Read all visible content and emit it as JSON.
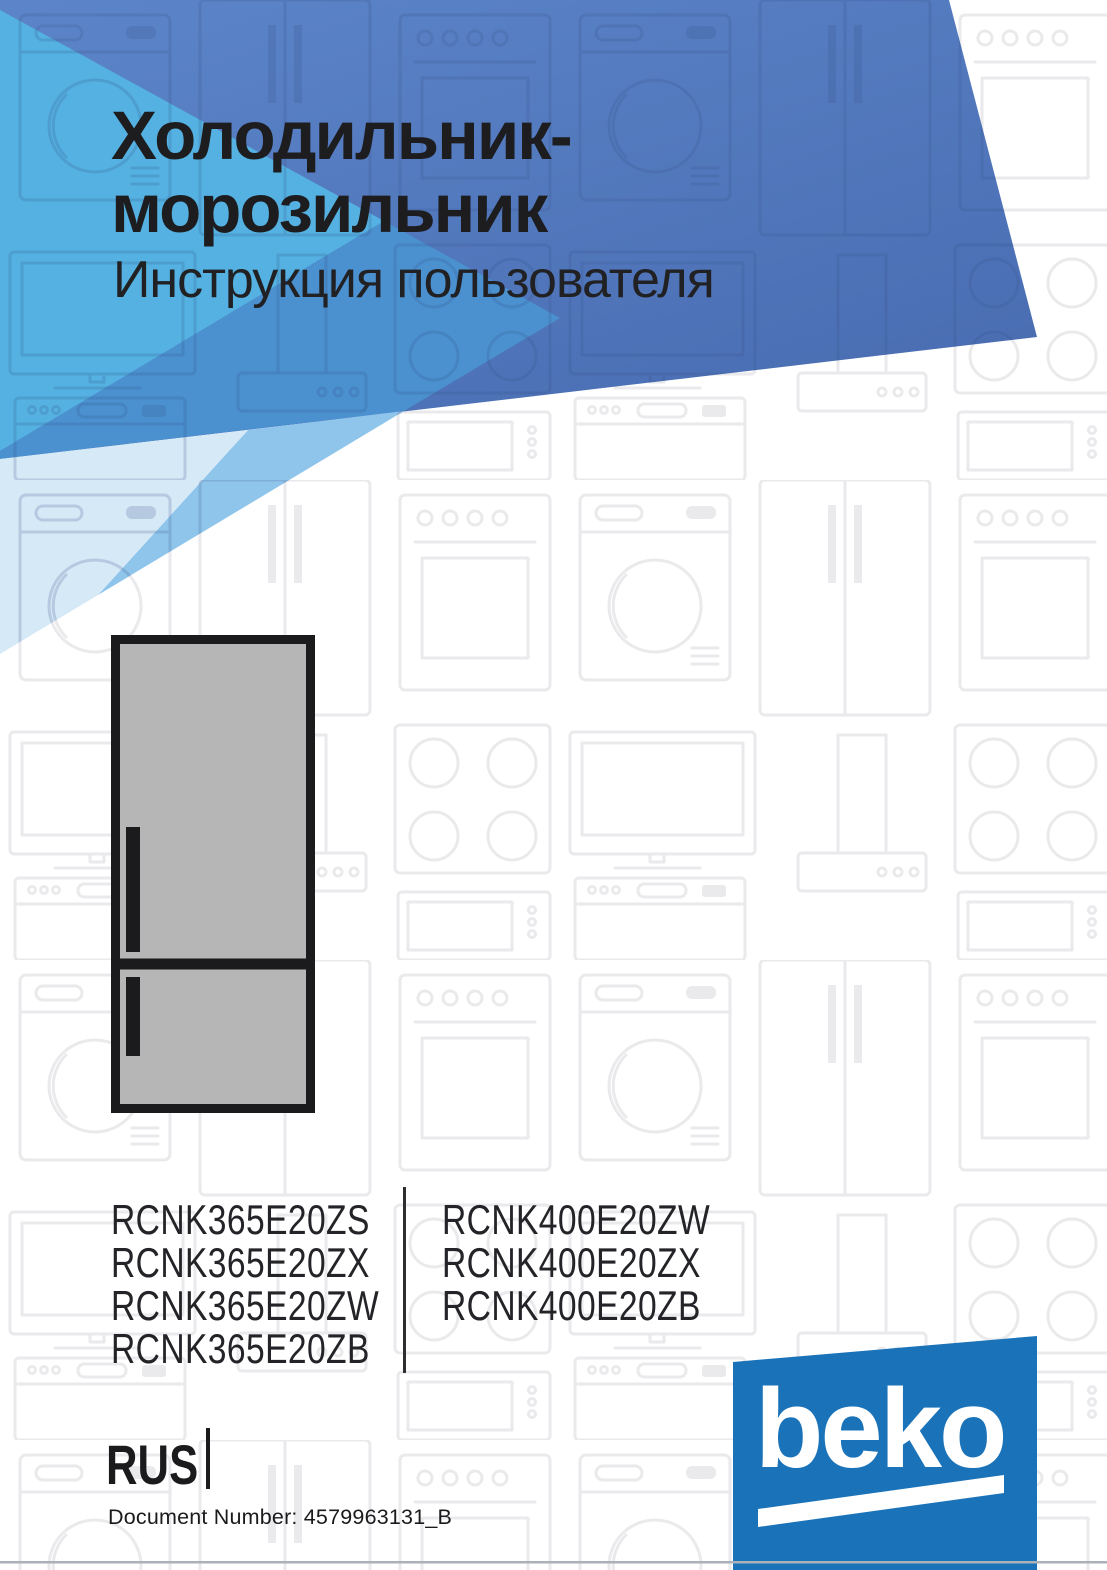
{
  "header": {
    "title_line1": "Холодильник-",
    "title_line2": "морозильник",
    "subtitle": "Инструкция пользователя"
  },
  "product": {
    "illustration": "bottom-freezer-refrigerator"
  },
  "models": {
    "left_column": [
      "RCNK365E20ZS",
      "RCNK365E20ZX",
      "RCNK365E20ZW",
      "RCNK365E20ZB"
    ],
    "right_column": [
      "RCNK400E20ZW",
      "RCNK400E20ZX",
      "RCNK400E20ZB"
    ]
  },
  "footer": {
    "language_code": "RUS",
    "document_number": "Document Number: 4579963131_B"
  },
  "brand": {
    "logo_text": "beko",
    "logo_color": "#1A72B8"
  },
  "colors": {
    "header_base_blue": "#5580C5",
    "header_vivid_blue": "#54B1E1",
    "header_mid_blue": "#4B90CF",
    "header_light_blue": "#90C5EB",
    "header_pale_blue": "#D6E9F7",
    "pattern_gray": "#EAEAEC",
    "fridge_fill": "#B6B6B7",
    "ink": "#1B1B1D"
  }
}
